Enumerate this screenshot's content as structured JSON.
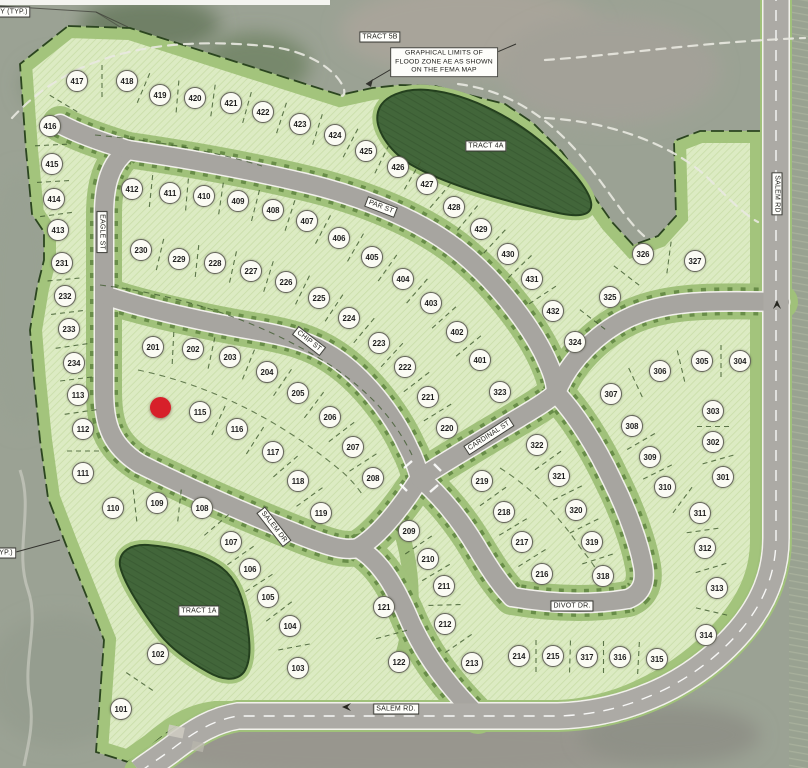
{
  "map": {
    "corner_note_top_left": "Y (TYP.)",
    "corner_note_left": "YP.)",
    "flood_note": "GRAPHICAL LIMITS OF\nFLOOD ZONE AE AS SHOWN\nON THE FEMA MAP",
    "tracts": {
      "t5b": "TRACT 5B",
      "t4a": "TRACT 4A",
      "t1a": "TRACT 1A"
    },
    "streets": {
      "eagle": "EAGLE ST",
      "par": "PAR ST",
      "chip": "CHIP ST",
      "cardinal": "CARDINAL ST",
      "salem_dr": "SALEM DR",
      "divot": "DIVOT DR.",
      "salem_bottom": "SALEM RD.",
      "salem_right": "SALEM RD"
    },
    "marker": {
      "x": 160,
      "y": 407,
      "color": "#d7202a"
    },
    "colors": {
      "lot_fill": "#dcebc3",
      "band_green": "#a3c47c",
      "tract_green": "#42663a",
      "road_gray": "#a7a5a0",
      "marker_red": "#d7202a"
    },
    "lots": [
      {
        "n": "101",
        "x": 121,
        "y": 709
      },
      {
        "n": "102",
        "x": 158,
        "y": 654
      },
      {
        "n": "103",
        "x": 298,
        "y": 668
      },
      {
        "n": "104",
        "x": 290,
        "y": 626
      },
      {
        "n": "105",
        "x": 268,
        "y": 597
      },
      {
        "n": "106",
        "x": 250,
        "y": 569
      },
      {
        "n": "107",
        "x": 231,
        "y": 542
      },
      {
        "n": "108",
        "x": 202,
        "y": 508
      },
      {
        "n": "109",
        "x": 157,
        "y": 503
      },
      {
        "n": "110",
        "x": 113,
        "y": 508
      },
      {
        "n": "111",
        "x": 83,
        "y": 473
      },
      {
        "n": "112",
        "x": 83,
        "y": 429
      },
      {
        "n": "113",
        "x": 78,
        "y": 395
      },
      {
        "n": "115",
        "x": 200,
        "y": 412
      },
      {
        "n": "116",
        "x": 237,
        "y": 429
      },
      {
        "n": "117",
        "x": 273,
        "y": 452
      },
      {
        "n": "118",
        "x": 298,
        "y": 481
      },
      {
        "n": "119",
        "x": 321,
        "y": 513
      },
      {
        "n": "121",
        "x": 384,
        "y": 607
      },
      {
        "n": "122",
        "x": 399,
        "y": 662
      },
      {
        "n": "201",
        "x": 153,
        "y": 347
      },
      {
        "n": "202",
        "x": 193,
        "y": 349
      },
      {
        "n": "203",
        "x": 230,
        "y": 357
      },
      {
        "n": "204",
        "x": 267,
        "y": 372
      },
      {
        "n": "205",
        "x": 298,
        "y": 393
      },
      {
        "n": "206",
        "x": 330,
        "y": 417
      },
      {
        "n": "207",
        "x": 353,
        "y": 447
      },
      {
        "n": "208",
        "x": 373,
        "y": 478
      },
      {
        "n": "209",
        "x": 409,
        "y": 531
      },
      {
        "n": "210",
        "x": 428,
        "y": 559
      },
      {
        "n": "211",
        "x": 444,
        "y": 586
      },
      {
        "n": "212",
        "x": 445,
        "y": 624
      },
      {
        "n": "213",
        "x": 472,
        "y": 663
      },
      {
        "n": "214",
        "x": 519,
        "y": 656
      },
      {
        "n": "215",
        "x": 553,
        "y": 656
      },
      {
        "n": "216",
        "x": 542,
        "y": 574
      },
      {
        "n": "217",
        "x": 522,
        "y": 542
      },
      {
        "n": "218",
        "x": 504,
        "y": 512
      },
      {
        "n": "219",
        "x": 482,
        "y": 481
      },
      {
        "n": "220",
        "x": 447,
        "y": 428
      },
      {
        "n": "221",
        "x": 428,
        "y": 397
      },
      {
        "n": "222",
        "x": 405,
        "y": 367
      },
      {
        "n": "223",
        "x": 379,
        "y": 343
      },
      {
        "n": "224",
        "x": 349,
        "y": 318
      },
      {
        "n": "225",
        "x": 319,
        "y": 298
      },
      {
        "n": "226",
        "x": 286,
        "y": 282
      },
      {
        "n": "227",
        "x": 251,
        "y": 271
      },
      {
        "n": "228",
        "x": 215,
        "y": 263
      },
      {
        "n": "229",
        "x": 179,
        "y": 259
      },
      {
        "n": "230",
        "x": 141,
        "y": 250
      },
      {
        "n": "231",
        "x": 62,
        "y": 263
      },
      {
        "n": "232",
        "x": 65,
        "y": 296
      },
      {
        "n": "233",
        "x": 69,
        "y": 329
      },
      {
        "n": "234",
        "x": 74,
        "y": 363
      },
      {
        "n": "301",
        "x": 723,
        "y": 477
      },
      {
        "n": "302",
        "x": 713,
        "y": 442
      },
      {
        "n": "303",
        "x": 713,
        "y": 411
      },
      {
        "n": "304",
        "x": 740,
        "y": 361
      },
      {
        "n": "305",
        "x": 702,
        "y": 361
      },
      {
        "n": "306",
        "x": 660,
        "y": 371
      },
      {
        "n": "307",
        "x": 611,
        "y": 394
      },
      {
        "n": "308",
        "x": 632,
        "y": 426
      },
      {
        "n": "309",
        "x": 650,
        "y": 457
      },
      {
        "n": "310",
        "x": 665,
        "y": 487
      },
      {
        "n": "311",
        "x": 700,
        "y": 513
      },
      {
        "n": "312",
        "x": 705,
        "y": 548
      },
      {
        "n": "313",
        "x": 717,
        "y": 588
      },
      {
        "n": "314",
        "x": 706,
        "y": 635
      },
      {
        "n": "315",
        "x": 657,
        "y": 659
      },
      {
        "n": "316",
        "x": 620,
        "y": 657
      },
      {
        "n": "317",
        "x": 587,
        "y": 657
      },
      {
        "n": "318",
        "x": 603,
        "y": 576
      },
      {
        "n": "319",
        "x": 592,
        "y": 542
      },
      {
        "n": "320",
        "x": 576,
        "y": 510
      },
      {
        "n": "321",
        "x": 559,
        "y": 476
      },
      {
        "n": "322",
        "x": 537,
        "y": 445
      },
      {
        "n": "323",
        "x": 500,
        "y": 392
      },
      {
        "n": "324",
        "x": 575,
        "y": 342
      },
      {
        "n": "325",
        "x": 610,
        "y": 297
      },
      {
        "n": "326",
        "x": 643,
        "y": 254
      },
      {
        "n": "327",
        "x": 695,
        "y": 261
      },
      {
        "n": "401",
        "x": 480,
        "y": 360
      },
      {
        "n": "402",
        "x": 457,
        "y": 332
      },
      {
        "n": "403",
        "x": 431,
        "y": 303
      },
      {
        "n": "404",
        "x": 403,
        "y": 279
      },
      {
        "n": "405",
        "x": 372,
        "y": 257
      },
      {
        "n": "406",
        "x": 339,
        "y": 238
      },
      {
        "n": "407",
        "x": 307,
        "y": 221
      },
      {
        "n": "408",
        "x": 273,
        "y": 210
      },
      {
        "n": "409",
        "x": 238,
        "y": 201
      },
      {
        "n": "410",
        "x": 204,
        "y": 196
      },
      {
        "n": "411",
        "x": 170,
        "y": 193
      },
      {
        "n": "412",
        "x": 132,
        "y": 189
      },
      {
        "n": "413",
        "x": 58,
        "y": 230
      },
      {
        "n": "414",
        "x": 54,
        "y": 199
      },
      {
        "n": "415",
        "x": 52,
        "y": 164
      },
      {
        "n": "416",
        "x": 50,
        "y": 126
      },
      {
        "n": "417",
        "x": 77,
        "y": 81
      },
      {
        "n": "418",
        "x": 127,
        "y": 81
      },
      {
        "n": "419",
        "x": 160,
        "y": 95
      },
      {
        "n": "420",
        "x": 195,
        "y": 98
      },
      {
        "n": "421",
        "x": 231,
        "y": 103
      },
      {
        "n": "422",
        "x": 263,
        "y": 112
      },
      {
        "n": "423",
        "x": 300,
        "y": 124
      },
      {
        "n": "424",
        "x": 335,
        "y": 135
      },
      {
        "n": "425",
        "x": 366,
        "y": 151
      },
      {
        "n": "426",
        "x": 398,
        "y": 167
      },
      {
        "n": "427",
        "x": 427,
        "y": 184
      },
      {
        "n": "428",
        "x": 454,
        "y": 207
      },
      {
        "n": "429",
        "x": 481,
        "y": 229
      },
      {
        "n": "430",
        "x": 508,
        "y": 254
      },
      {
        "n": "431",
        "x": 532,
        "y": 279
      },
      {
        "n": "432",
        "x": 553,
        "y": 311
      }
    ],
    "lot_rows": [
      [
        "417",
        "416",
        "415",
        "414",
        "413"
      ],
      [
        "417",
        "418",
        "419",
        "420",
        "421",
        "422",
        "423",
        "424",
        "425",
        "426",
        "427",
        "428",
        "429",
        "430",
        "431",
        "432"
      ],
      [
        "412",
        "411",
        "410",
        "409",
        "408",
        "407",
        "406",
        "405",
        "404",
        "403",
        "402",
        "401"
      ],
      [
        "231",
        "232",
        "233",
        "234",
        "113",
        "112",
        "111"
      ],
      [
        "230",
        "229",
        "228",
        "227",
        "226",
        "225",
        "224",
        "223",
        "222",
        "221",
        "220"
      ],
      [
        "201",
        "202",
        "203",
        "204",
        "205",
        "206",
        "207",
        "208"
      ],
      [
        "115",
        "116",
        "117",
        "118",
        "119"
      ],
      [
        "110",
        "109",
        "108",
        "107",
        "106",
        "105",
        "104",
        "103"
      ],
      [
        "102",
        "101"
      ],
      [
        "121",
        "122"
      ],
      [
        "209",
        "210",
        "211",
        "212",
        "213"
      ],
      [
        "214",
        "215",
        "317",
        "316",
        "315"
      ],
      [
        "219",
        "218",
        "217",
        "216"
      ],
      [
        "322",
        "321",
        "320",
        "319",
        "318"
      ],
      [
        "324",
        "325",
        "326",
        "327"
      ],
      [
        "307",
        "306",
        "305",
        "304"
      ],
      [
        "308",
        "309",
        "310",
        "311",
        "312",
        "313",
        "314"
      ],
      [
        "303",
        "302",
        "301"
      ]
    ]
  }
}
